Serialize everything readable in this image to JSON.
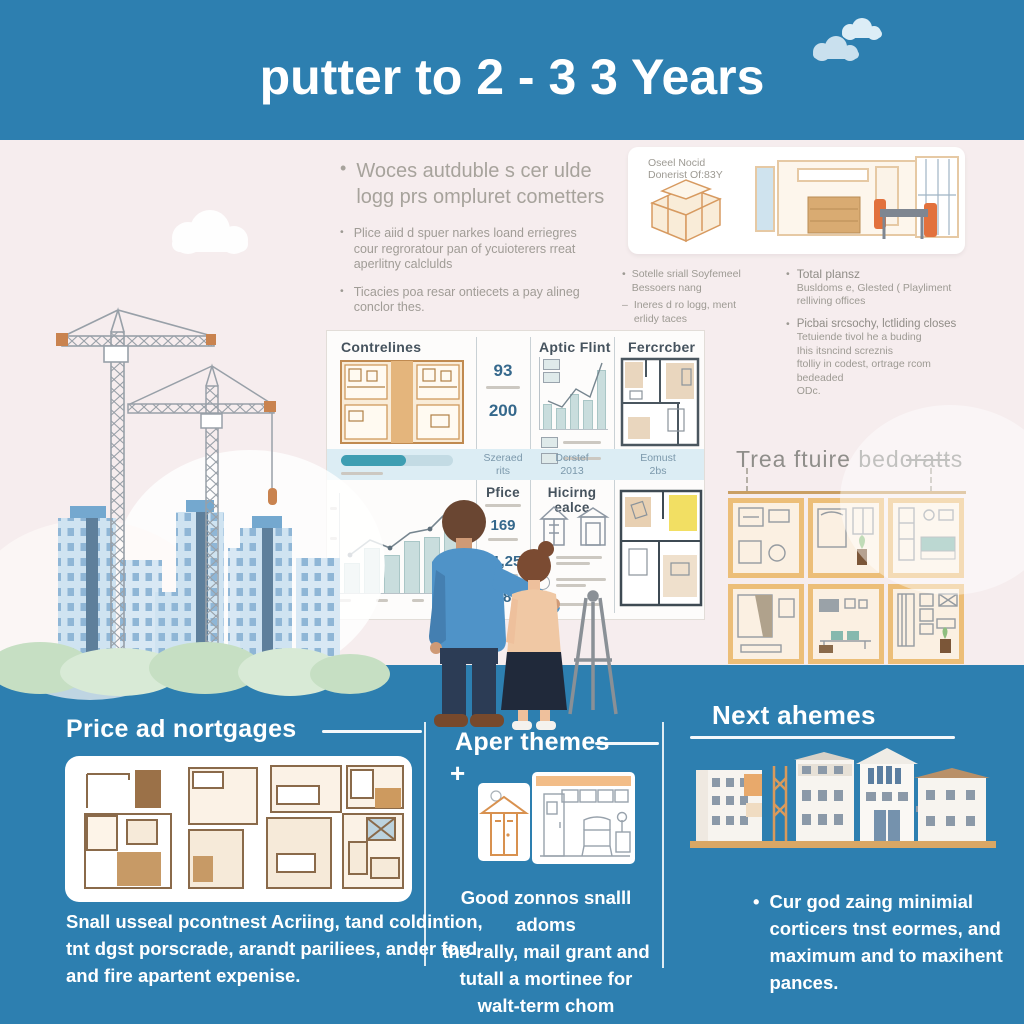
{
  "glyphs": {
    "bullet": "•",
    "dash_bullet": "–",
    "dot": "·",
    "plus": "+"
  },
  "header": {
    "title": "putter to 2 - 3 3 Years"
  },
  "intro": {
    "primary": [
      "Woces autduble s cer ulde",
      "logg prs ompluret cometters"
    ],
    "bullet2": [
      "Plice aiid d spuer narkes loand erriegres",
      "cour regroratour pan of ycuioterers rreat",
      "aperlitny calclulds"
    ],
    "bullet3": [
      "Ticacies poa resar ontiecets a pay alineg",
      "conclor thes."
    ]
  },
  "model_card": {
    "label": [
      "Oseel Nocid",
      "Donerist Of:83Y"
    ]
  },
  "notes": {
    "a1": [
      "Sotelle sriall Soyfemeel",
      "Bessoers nang"
    ],
    "a2": [
      "Ineres d ro logg, ment",
      "erlidy taces"
    ],
    "b1_title": "Total plansz",
    "b1_sub": [
      "Busldoms e, Glested ( Playliment",
      "relliving offices"
    ],
    "b2_title": "Picbai srcsochy, lctliding closes",
    "b2_sub": [
      "Tetuiende tivol he a buding",
      "Ihis itsncind screznis",
      "ftolliy in codest, ortrage rcom",
      "bedeaded",
      "ODc."
    ]
  },
  "table": {
    "headers": {
      "col1": "Contrelines",
      "col3": "Aptic Flint",
      "col4": "Fercrcber"
    },
    "stats": {
      "n1": "93",
      "n2": "200"
    },
    "progress_pct": 58,
    "band": {
      "c2": [
        "Szeraed",
        "rits"
      ],
      "c3": [
        "Dcrstef",
        "2013"
      ],
      "c4": [
        "Eomust",
        "2bs"
      ]
    },
    "row2": {
      "c2_title": "Pfice",
      "c2_nums": [
        "169",
        "11,25",
        "98"
      ],
      "c3_title": "Hicirng ealce"
    }
  },
  "frames": {
    "title": "Trea ftuire bedoratts"
  },
  "bottom": {
    "col1": {
      "title": "Price ad nortgages",
      "lines": [
        "Snall usseal pcontnest Acriing, tand coldintion,",
        "tnt dgst porscrade, arandt pariliees, ander ford",
        "and fire apartent expenise."
      ]
    },
    "col2": {
      "title": "Aper themes",
      "lines": [
        "Good zonnos snalll adoms",
        "the-rally, mail grant and",
        "tutall a mortinee for",
        "walt-term chom yourinpes."
      ]
    },
    "col3": {
      "title": "Next ahemes",
      "lines": [
        "Cur god zaing minimial",
        "corticers tnst eormes, and",
        "maximum and to maxihent",
        "pances."
      ]
    }
  },
  "chart_data": [
    {
      "type": "bar",
      "id": "contrelines-price-trend",
      "values": [
        32,
        48,
        40,
        55,
        60,
        80
      ],
      "overlay": "trend-line",
      "ylim": [
        0,
        100
      ]
    },
    {
      "type": "bar",
      "id": "aptic-flint-growth",
      "values": [
        36,
        30,
        52,
        42,
        88
      ],
      "overlay": "trend-line",
      "ylim": [
        0,
        100
      ]
    }
  ],
  "colors": {
    "blue": "#2d7fb0",
    "bg": "#f6edee",
    "tan": "#ecbe78",
    "steel": "#35688c",
    "band": "#dcedf4",
    "teal": "#3e9eb2"
  }
}
